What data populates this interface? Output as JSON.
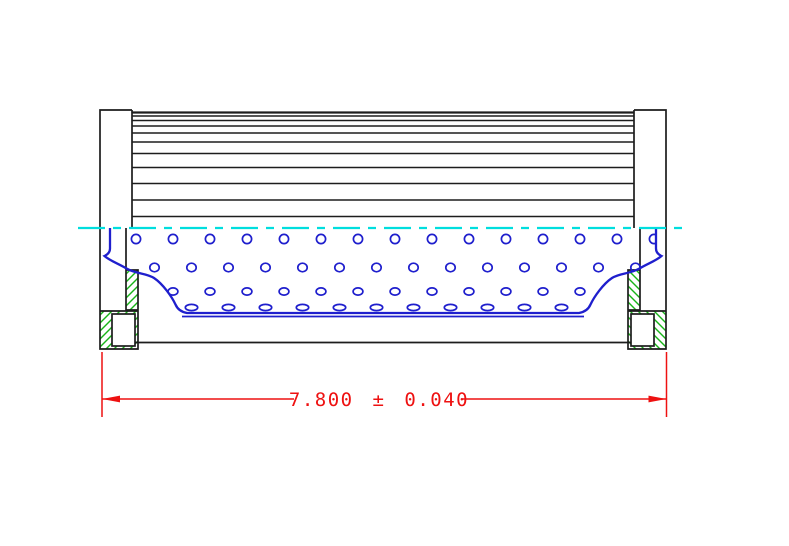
{
  "dimension": {
    "label": "7.800 ± 0.040",
    "value": "7.800",
    "plus_minus": "±",
    "tolerance": "0.040"
  },
  "colors": {
    "outline": "#1d1d1d",
    "blue": "#1f1fcd",
    "cyan": "#00dede",
    "green": "#18b418",
    "red": "#ee1111",
    "background": "#ffffff"
  },
  "drawing": {
    "media_lines": {
      "x1": 132,
      "x2": 634,
      "ys": [
        112.5,
        116,
        120.5,
        126,
        133,
        142,
        153.5,
        167.5,
        183.5,
        200,
        216.5
      ],
      "top_line_width": 2.2,
      "line_width": 1.5
    },
    "perforation_rows": [
      {
        "y": 239,
        "rx": 4.6,
        "ry": 4.6,
        "x_start": 136,
        "x_step": 37,
        "count": 15
      },
      {
        "y": 267.5,
        "rx": 4.7,
        "ry": 4.3,
        "x_start": 154.5,
        "x_step": 37,
        "count": 14
      },
      {
        "y": 291.5,
        "rx": 4.9,
        "ry": 3.6,
        "x_start": 136,
        "x_step": 37,
        "count": 15
      },
      {
        "y": 307.5,
        "rx": 6.2,
        "ry": 3.1,
        "x_start": 154.5,
        "x_step": 37,
        "count": 12
      }
    ],
    "hatch": {
      "spacing": 8,
      "regions": [
        {
          "x": 126,
          "y": 270,
          "w": 12,
          "h": 40
        },
        {
          "x": 100,
          "y": 311,
          "w": 38,
          "h": 38
        }
      ]
    },
    "centerline": {
      "y": 228,
      "x1": 78,
      "x2": 687
    }
  }
}
